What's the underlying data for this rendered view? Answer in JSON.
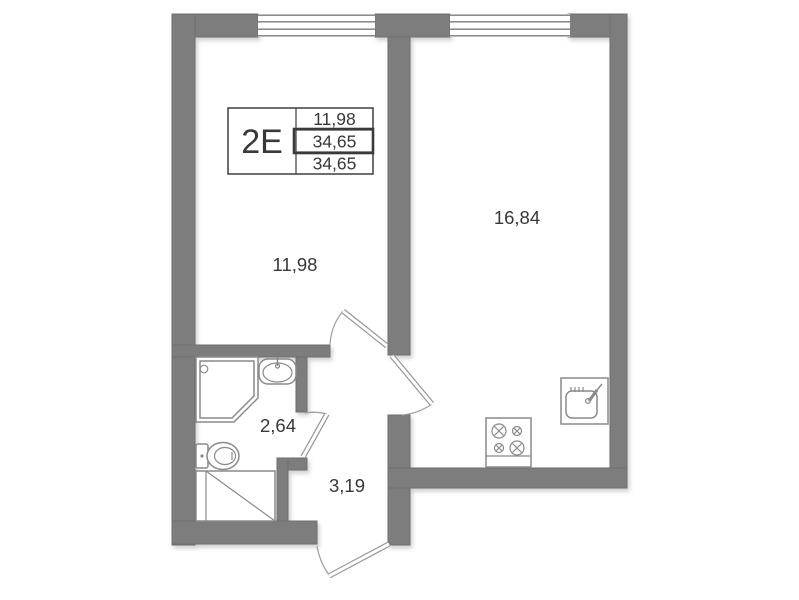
{
  "unit": {
    "table": {
      "type": "2E",
      "values": [
        "11,98",
        "34,65",
        "34,65"
      ]
    }
  },
  "rooms": {
    "living": {
      "area": "11,98"
    },
    "kitchen": {
      "area": "16,84"
    },
    "bathroom": {
      "area": "2,64"
    },
    "hallway": {
      "area": "3,19"
    }
  },
  "icons": [
    "window-icon",
    "door-swing-icon",
    "shower-icon",
    "washbasin-icon",
    "toilet-icon",
    "appliance-niche-icon",
    "stove-icon",
    "kitchen-sink-icon"
  ],
  "colors": {
    "wall": "#7d7d7d",
    "fixture_line": "#8a8a8a",
    "text": "#383838",
    "background": "#ffffff"
  }
}
